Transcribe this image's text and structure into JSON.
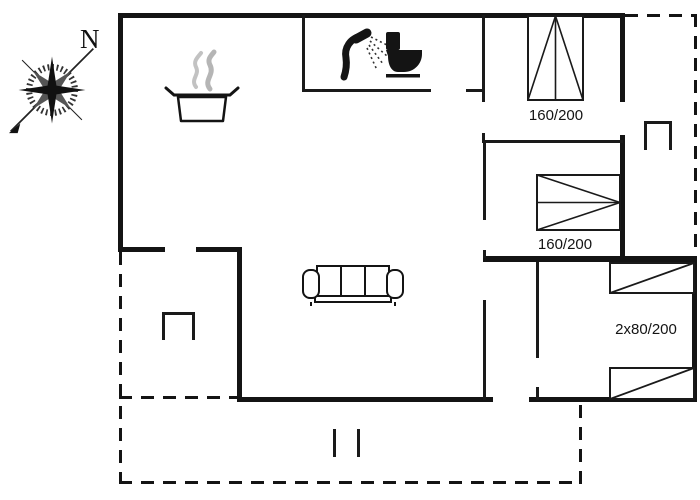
{
  "compass": {
    "north_label": "N"
  },
  "bedrooms": [
    {
      "id": "bedroom-top-right",
      "bed_size_label": "160/200"
    },
    {
      "id": "bedroom-middle-right",
      "bed_size_label": "160/200"
    },
    {
      "id": "bedroom-bottom-right",
      "bed_size_label": "2x80/200"
    }
  ],
  "colors": {
    "wall": "#141414",
    "background": "#ffffff",
    "steam": "#c2c2c2"
  },
  "icons": [
    "compass-rose-icon",
    "cooking-pot-icon",
    "steam-icon",
    "shower-icon",
    "toilet-icon",
    "sofa-icon",
    "double-bed-icon",
    "single-bed-icon",
    "steps-icon"
  ]
}
